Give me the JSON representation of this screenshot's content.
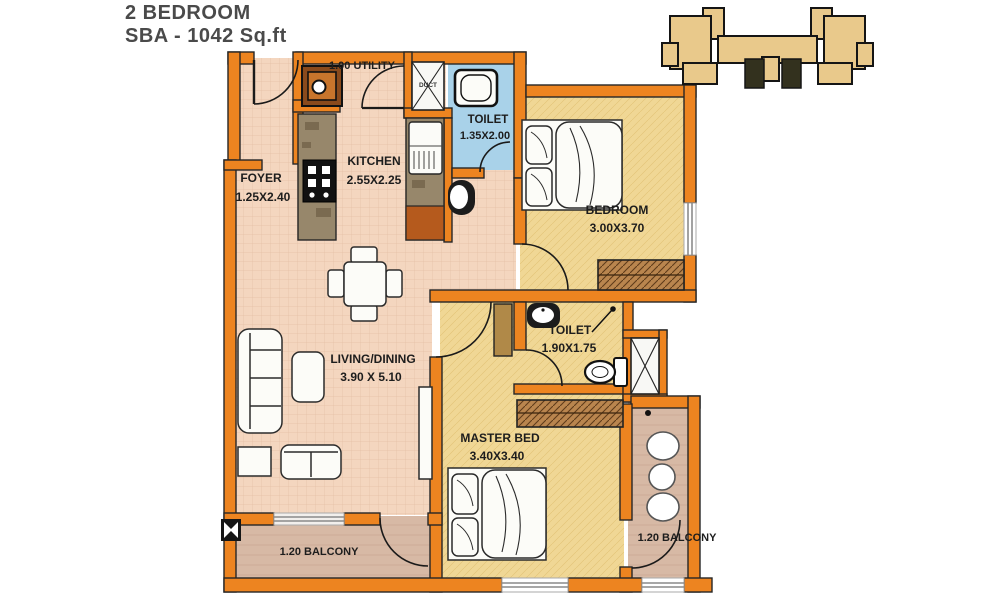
{
  "title": {
    "line1": "2 BEDROOM",
    "line2": "SBA - 1042 Sq.ft"
  },
  "rooms": {
    "utility": {
      "label": "1.00 UTILITY"
    },
    "duct": {
      "label": "DUCT"
    },
    "toilet1": {
      "name": "TOILET",
      "dims": "1.35X2.00"
    },
    "foyer": {
      "name": "FOYER",
      "dims": "1.25X2.40"
    },
    "kitchen": {
      "name": "KITCHEN",
      "dims": "2.55X2.25"
    },
    "bedroom": {
      "name": "BEDROOM",
      "dims": "3.00X3.70"
    },
    "living": {
      "name": "LIVING/DINING",
      "dims": "3.90 X 5.10"
    },
    "toilet2": {
      "name": "TOILET",
      "dims": "1.90X1.75"
    },
    "master": {
      "name": "MASTER BED",
      "dims": "3.40X3.40"
    },
    "balcony_bottom": {
      "label": "1.20 BALCONY"
    },
    "balcony_right": {
      "label": "1.20 BALCONY"
    }
  },
  "colors": {
    "wall_orange": "#ED8420",
    "floor_salmon": "#F4D6BF",
    "floor_yellow": "#F0D795",
    "toilet_blue": "#A9D2E9",
    "balcony_brown": "#D7B9A5",
    "counter_brown": "#97876B",
    "keyplan_tan": "#E9C98B",
    "outline_dark": "#222222"
  }
}
